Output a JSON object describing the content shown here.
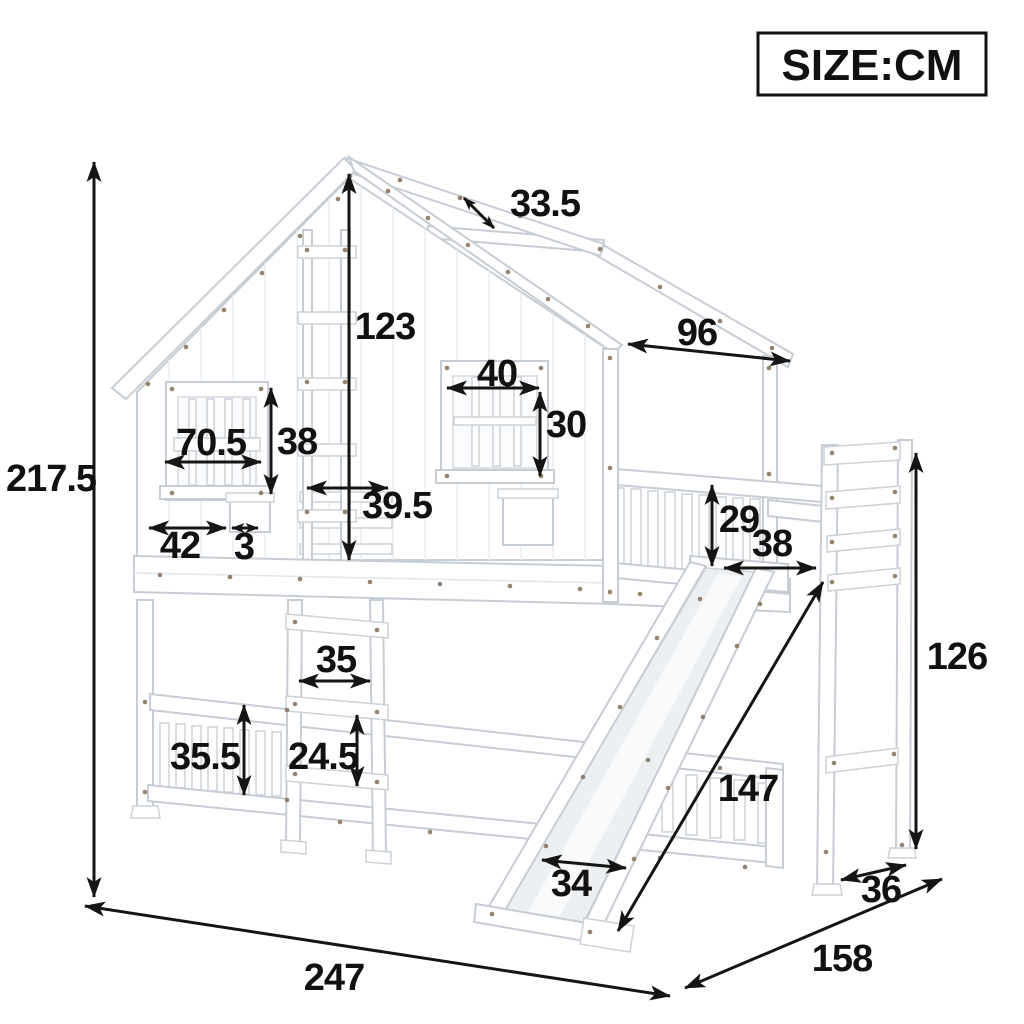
{
  "size_label": "SIZE:CM",
  "unit": "cm",
  "dimensions": [
    {
      "name": "total-height",
      "value": "217.5"
    },
    {
      "name": "roof-beam-gap",
      "value": "33.5"
    },
    {
      "name": "peak-to-upper-bunk",
      "value": "123"
    },
    {
      "name": "roof-side-length",
      "value": "96"
    },
    {
      "name": "right-window-width",
      "value": "40"
    },
    {
      "name": "right-window-height",
      "value": "30"
    },
    {
      "name": "left-window-width",
      "value": "70.5"
    },
    {
      "name": "left-window-height",
      "value": "38"
    },
    {
      "name": "door-opening-width",
      "value": "39.5"
    },
    {
      "name": "wall-ledge-width",
      "value": "42"
    },
    {
      "name": "ledge-thickness",
      "value": "3"
    },
    {
      "name": "upper-guardrail-height",
      "value": "29"
    },
    {
      "name": "slide-opening-width",
      "value": "38"
    },
    {
      "name": "rear-ladder-height",
      "value": "126"
    },
    {
      "name": "front-ladder-width",
      "value": "35"
    },
    {
      "name": "lower-guardrail-height",
      "value": "35.5"
    },
    {
      "name": "ladder-rung-spacing",
      "value": "24.5"
    },
    {
      "name": "slide-length",
      "value": "147"
    },
    {
      "name": "slide-width",
      "value": "34"
    },
    {
      "name": "rear-ladder-depth",
      "value": "36"
    },
    {
      "name": "bed-depth",
      "value": "158"
    },
    {
      "name": "bed-length",
      "value": "247"
    }
  ]
}
